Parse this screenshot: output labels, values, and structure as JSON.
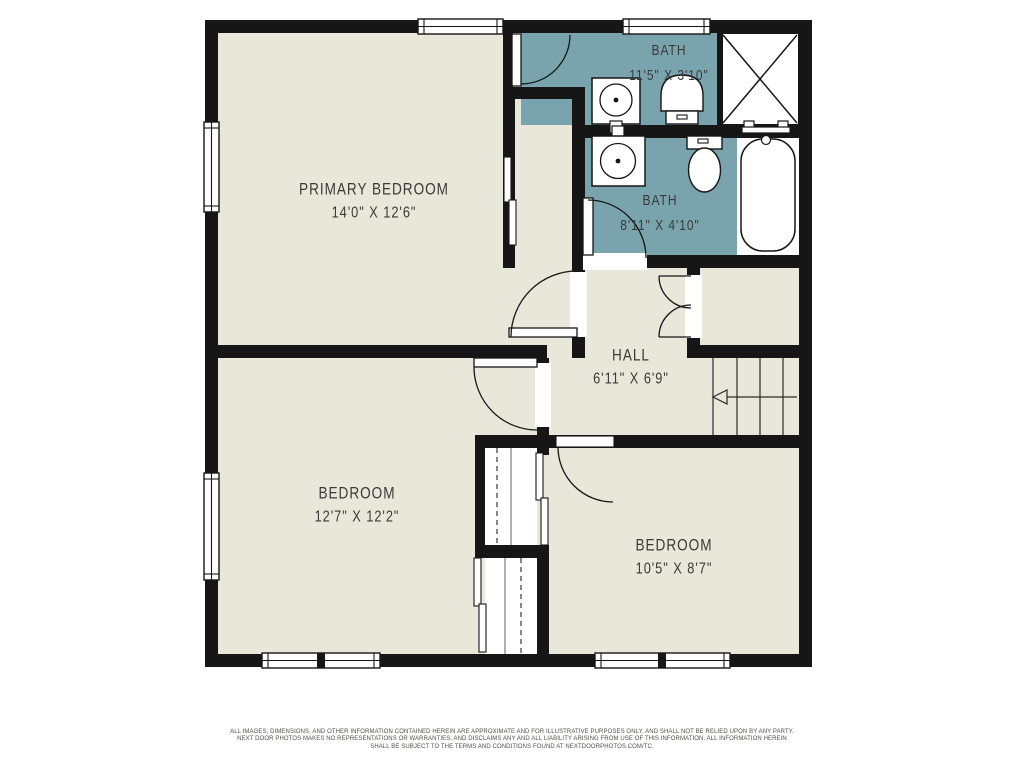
{
  "floorplan": {
    "wall_color": "#161616",
    "floor_color": "#e9e6da",
    "bath_floor_color": "#7aa4ad",
    "background": "#ffffff"
  },
  "rooms": {
    "primary_bedroom": {
      "label": "PRIMARY BEDROOM",
      "dims": "14'0\" X 12'6\""
    },
    "bath_top": {
      "label": "BATH",
      "dims": "11'5\" X 3'10\""
    },
    "bath_main": {
      "label": "BATH",
      "dims": "8'11\" X 4'10\""
    },
    "hall": {
      "label": "HALL",
      "dims": "6'11\" X 6'9\""
    },
    "bedroom_left": {
      "label": "BEDROOM",
      "dims": "12'7\" X 12'2\""
    },
    "bedroom_right": {
      "label": "BEDROOM",
      "dims": "10'5\" X 8'7\""
    }
  },
  "disclaimer": {
    "line1": "ALL IMAGES, DIMENSIONS, AND OTHER INFORMATION CONTAINED HEREIN ARE APPROXIMATE AND FOR ILLUSTRATIVE PURPOSES ONLY, AND SHALL NOT BE RELIED UPON BY ANY PARTY.",
    "line2": "NEXT DOOR PHOTOS MAKES NO REPRESENTATIONS OR WARRANTIES, AND DISCLAIMS ANY AND ALL LIABILITY ARISING FROM USE OF THIS INFORMATION. ALL INFORMATION HEREIN",
    "line3": "SHALL BE SUBJECT TO THE TERMS AND CONDITIONS FOUND AT NEXTDOORPHOTOS.COM/TC."
  }
}
